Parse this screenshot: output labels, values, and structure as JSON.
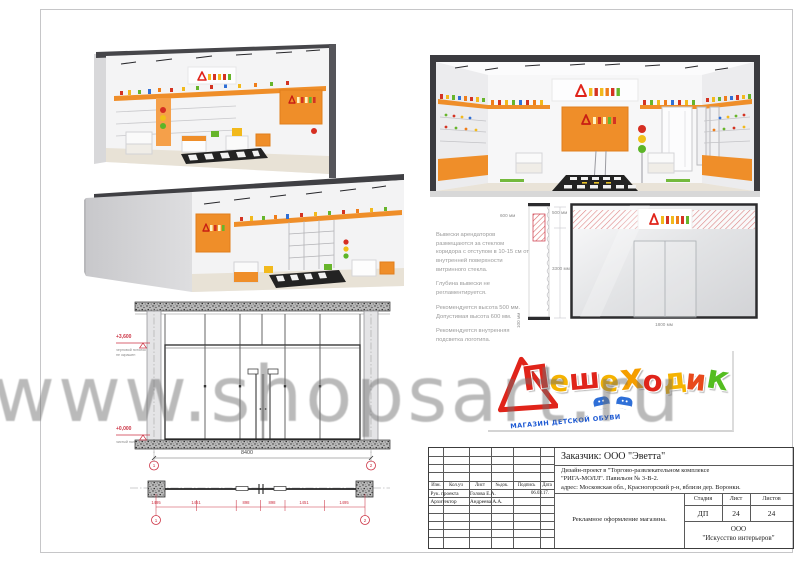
{
  "watermark": {
    "text": "www.shopsart.ru"
  },
  "logo": {
    "letters": [
      {
        "ch": "П",
        "color": "#e0241a"
      },
      {
        "ch": "е",
        "color": "#f5b301"
      },
      {
        "ch": "ш",
        "color": "#e0241a"
      },
      {
        "ch": "е",
        "color": "#f5b301"
      },
      {
        "ch": "х",
        "color": "#f59e00"
      },
      {
        "ch": "о",
        "color": "#e0241a"
      },
      {
        "ch": "д",
        "color": "#f5b301"
      },
      {
        "ch": "и",
        "color": "#e8491c"
      },
      {
        "ch": "к",
        "color": "#54bd20"
      }
    ],
    "caption": "МАГАЗИН ДЕТСКОЙ ОБУВИ",
    "caption_color": "#1f5bd4"
  },
  "facade_spec": {
    "notes": [
      "Вывески арендаторов размещаются за стеклом коридора с отступом в 10-15 см от внутренней поверхности витринного стекла.",
      "Глубина вывески не регламентируется.",
      "Рекомендуется высота 500 мм. Допустимая высота 600 мм.",
      "Рекомендуется внутренняя подсветка логотипа."
    ],
    "dims": {
      "sign_offset": "600 мм",
      "sign_zone": "500 мм",
      "glass_height": "3300 мм",
      "strip_width": "100 мм",
      "door_width": "1800 мм"
    }
  },
  "elevation": {
    "level_top": "+3,600",
    "level_top_note_1": "черновой потолок",
    "level_top_note_2": "не окрашен",
    "level_bottom": "+0,000",
    "level_bottom_note": "чистый пол",
    "total_width": "8400",
    "axis_left": "1",
    "axis_right": "2"
  },
  "plan": {
    "segments": [
      "1495",
      "1451",
      "898",
      "898",
      "1451",
      "1495"
    ],
    "axis_left": "1",
    "axis_right": "2"
  },
  "title_block": {
    "client": "Заказчик:  ООО \"Эветта\"",
    "project_line1": "Дизайн-проект в  \"Торгово-развлекательном комплексе",
    "project_line2": "\"РИГА-МОЛЛ\". Павильон № 3-В-2.",
    "project_line3": "адрес: Московская обл., Красногорский р-н, вблизи дер. Воронки.",
    "col_izm": "Изм.",
    "col_koluch": "Кол.уч",
    "col_list": "Лист",
    "col_ndok": "№док.",
    "col_podpis": "Подпись",
    "col_data": "Дата",
    "row1_role": "Рук. проекта",
    "row1_name": "Голова Е.А.",
    "row1_date": "06.03.17.",
    "row2_role": "Архитектор",
    "row2_name": "Андреева А.А.",
    "stage_label": "Стадия",
    "sheet_label": "Лист",
    "sheets_label": "Листов",
    "stage_value": "ДП",
    "sheet_value": "24",
    "sheets_value": "24",
    "subject": "Рекламное оформление магазина.",
    "company_line1": "ООО",
    "company_line2": "\"Искусство интерьеров\""
  }
}
